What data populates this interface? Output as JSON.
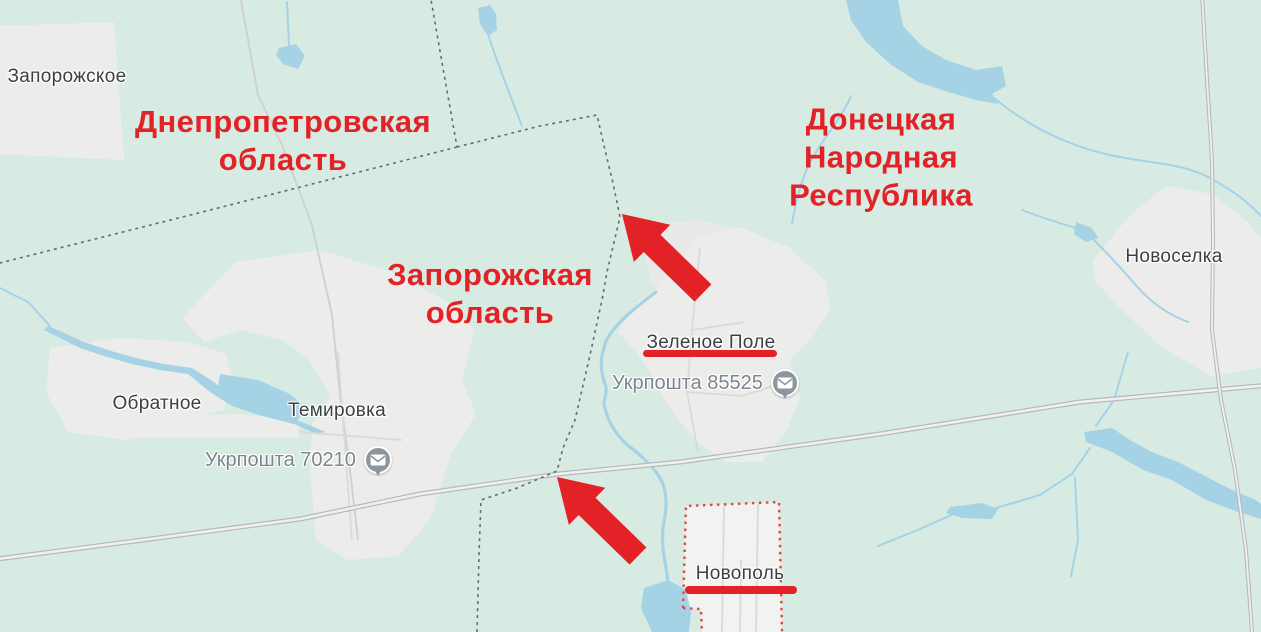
{
  "theme": {
    "map-bg": "#d7ebe2",
    "water": "#a6d2e6",
    "urban": "#ecedeb",
    "road-casing": "#b6b8bb",
    "road-fill": "#eff1f1",
    "minor-road": "#d0d2d0",
    "border-dash": "#5f6d75",
    "selected-region-border": "#dd4b3e",
    "place-label": "#3c4043",
    "poi-label": "#7a858d",
    "annotation-red": "#e32227",
    "pin-gray": "#8d969e"
  },
  "region_annotations": [
    {
      "id": "dnipropetrovsk-oblast",
      "text": "Днепропетровская\nобласть"
    },
    {
      "id": "donetsk-peoples-republic",
      "text": "Донецкая\nНародная\nРеспублика"
    },
    {
      "id": "zaporizhzhia-oblast",
      "text": "Запорожская\nобласть"
    }
  ],
  "places": [
    {
      "name": "Запорожское",
      "underlined": false
    },
    {
      "name": "Обратное",
      "underlined": false
    },
    {
      "name": "Темировка",
      "underlined": false
    },
    {
      "name": "Новоселка",
      "underlined": false
    },
    {
      "name": "Зеленое Поле",
      "underlined": true
    },
    {
      "name": "Новополь",
      "underlined": true
    }
  ],
  "poi": [
    {
      "label": "Укрпошта 70210",
      "icon": "mail-pin-icon"
    },
    {
      "label": "Укрпошта 85525",
      "icon": "mail-pin-icon"
    }
  ],
  "annotations": {
    "arrow_count": 2,
    "underlined_places": [
      "Зеленое Поле",
      "Новополь"
    ]
  }
}
